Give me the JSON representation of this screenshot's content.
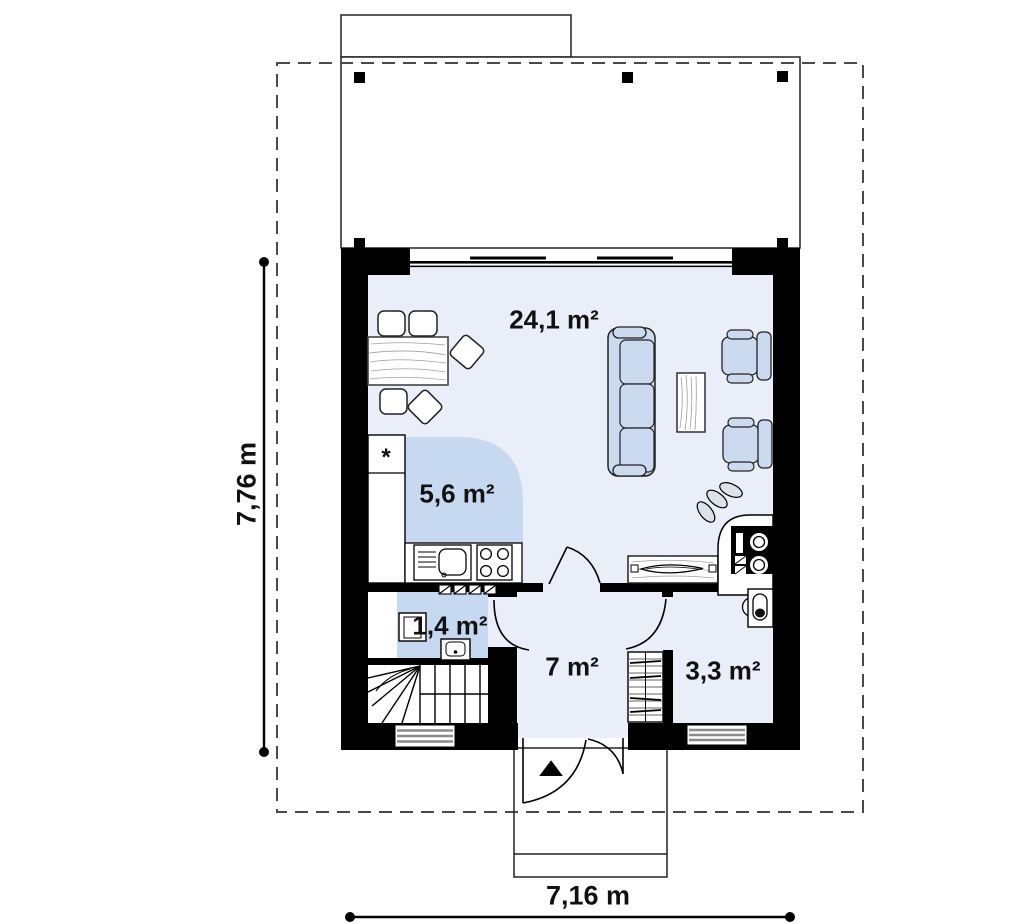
{
  "drawing": {
    "type": "floor-plan",
    "rooms": {
      "living": "24,1 m²",
      "kitchen": "5,6 m²",
      "wc": "1,4 m²",
      "hall": "7 m²",
      "storage": "3,3 m²"
    },
    "dimensions": {
      "width": "7,16 m",
      "height": "7,76 m"
    },
    "symbols": {
      "fridge_marker": "*",
      "entrance_arrow": "▲"
    },
    "colors": {
      "wall": "#000000",
      "floor": "#eaeef9",
      "zone_blue": "#c6d9f1",
      "furniture_blue": "#ccdaf0",
      "window_stripe": "#8a8a8a",
      "boundary_dash": "#4a4a4a",
      "text": "#111111"
    }
  }
}
